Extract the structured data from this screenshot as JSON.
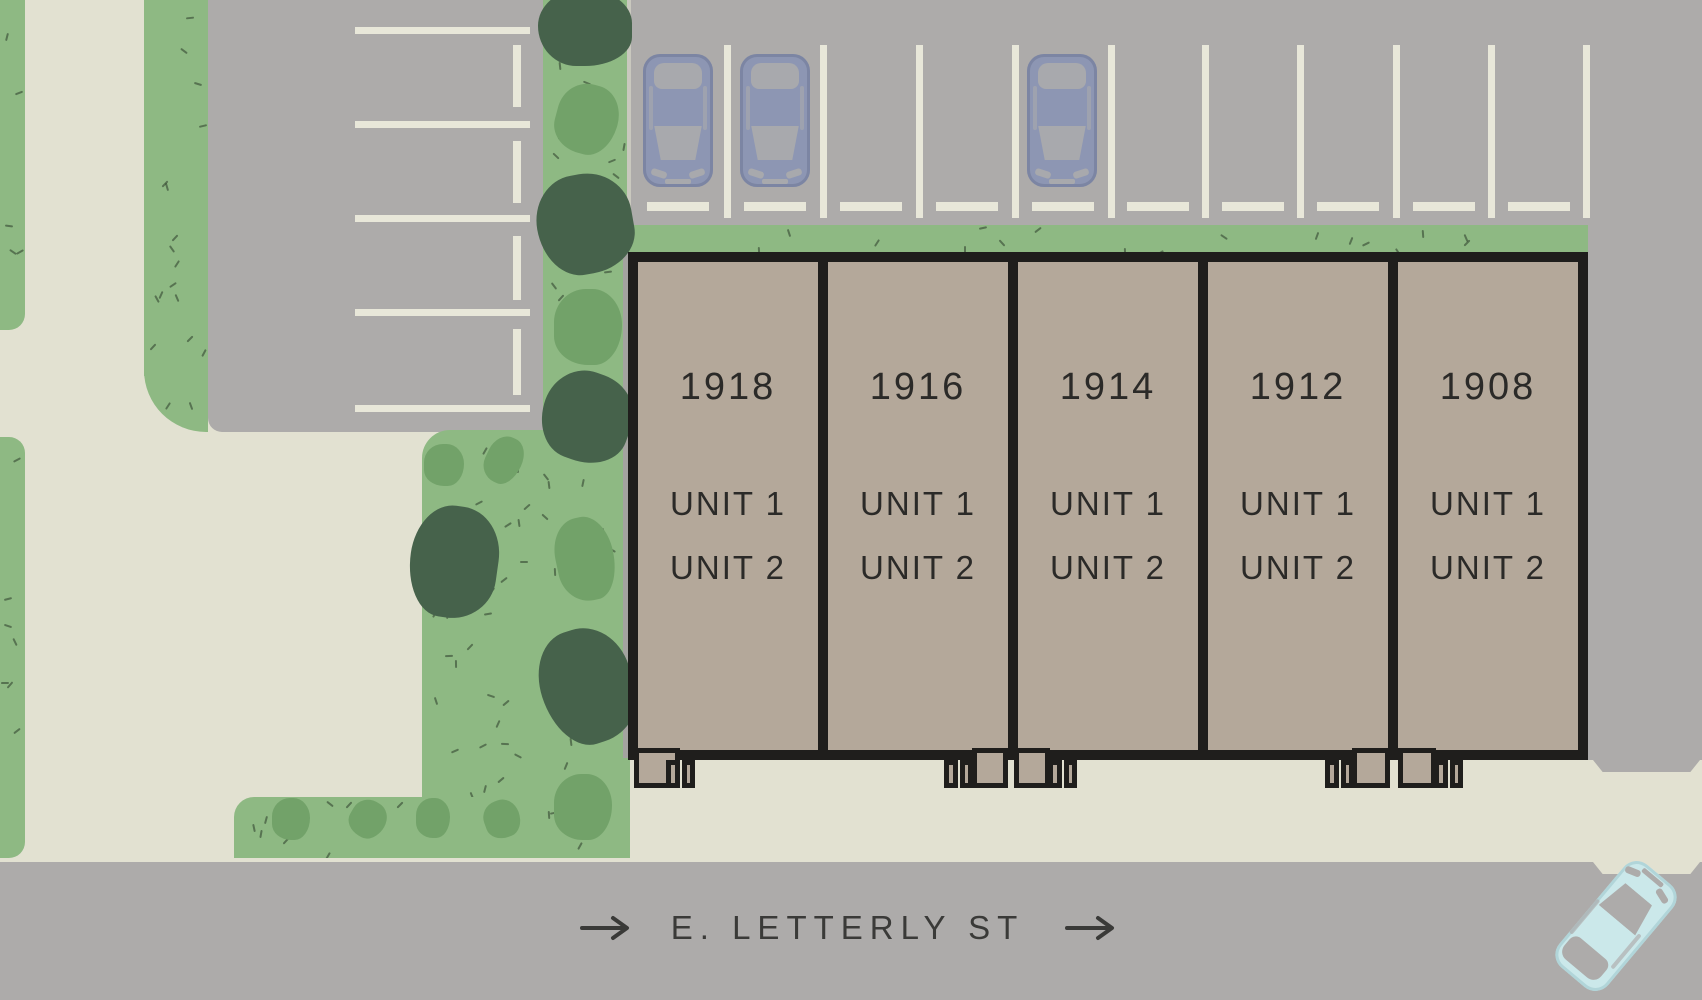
{
  "site": {
    "title": "Townhome site plan",
    "street": {
      "label": "E. LETTERLY ST"
    },
    "buildings": [
      {
        "number": "1918",
        "unit1": "UNIT 1",
        "unit2": "UNIT 2"
      },
      {
        "number": "1916",
        "unit1": "UNIT 1",
        "unit2": "UNIT 2"
      },
      {
        "number": "1914",
        "unit1": "UNIT 1",
        "unit2": "UNIT 2"
      },
      {
        "number": "1912",
        "unit1": "UNIT 1",
        "unit2": "UNIT 2"
      },
      {
        "number": "1908",
        "unit1": "UNIT 1",
        "unit2": "UNIT 2"
      }
    ],
    "parking": {
      "top_lot_stall_lines": 10,
      "left_lot_stall_lines": 5,
      "parked_cars": 3,
      "street_cars": 1
    }
  },
  "colors": {
    "asphalt": "#adabaa",
    "sidewalk": "#e2e1d1",
    "grass": "#8eb983",
    "bush": "#72a269",
    "tree": "#46624b",
    "building_fill": "#b4a89a",
    "outline": "#1f1e1c",
    "stall_line": "#e8e7d9",
    "car_blue": "#8d96b3",
    "car_teal": "#cbe8ea",
    "text": "#2b2a28",
    "street_text": "#3a3a38"
  }
}
